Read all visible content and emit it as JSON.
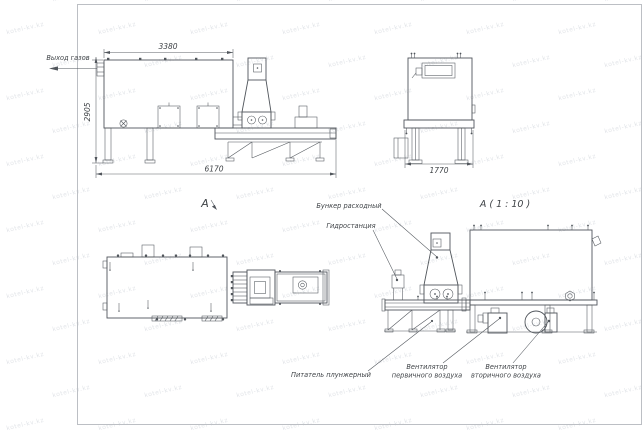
{
  "watermark": {
    "text": "kotel-kv.kz"
  },
  "colors": {
    "line": "#51565c",
    "text": "#3f4347",
    "watermark": "#b9bfc8",
    "background": "#ffffff"
  },
  "views": {
    "side_elevation": {
      "gas_outlet_label": "Выход газов",
      "dim_top": "3380",
      "dim_left": "2905",
      "dim_bottom": "6170"
    },
    "end_elevation": {
      "dim_bottom": "1770"
    },
    "plan": {
      "view_arrow_label": "А"
    },
    "detail": {
      "title": "А ( 1 : 10 )",
      "labels": {
        "feed_hopper": "Бункер расходный",
        "hydraulic_station": "Гидростанция",
        "plunger_feeder": "Питатель плунжерный",
        "primary_air_fan_line1": "Вентилятор",
        "primary_air_fan_line2": "первичного воздуха",
        "secondary_air_fan_line1": "Вентилятор",
        "secondary_air_fan_line2": "вторичного воздуха"
      }
    }
  }
}
